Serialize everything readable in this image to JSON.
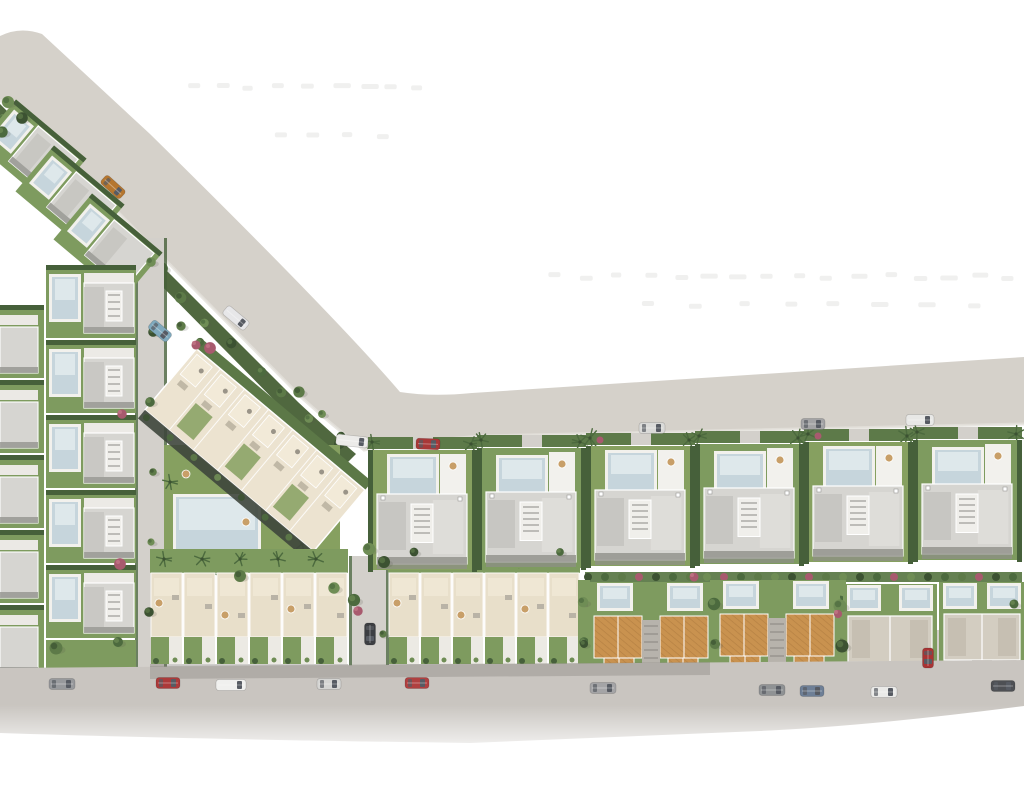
{
  "canvas": {
    "w": 1024,
    "h": 787
  },
  "palette": {
    "bg": "#ffffff",
    "road": "#d5d1ca",
    "road_edge": "#e4e1db",
    "road_bottom": "#c9c5c0",
    "road_shade": "#77736c",
    "street": "#d3d0cb",
    "lawn": "#7e9b5f",
    "lawn_alt": "#86a060",
    "hedge": "#46603a",
    "hedge_mid": "#5d7a49",
    "roof": "#d6d5d1",
    "roof_dark": "#c5c4c0",
    "roof_light": "#deddd9",
    "roof_shadow": "#94948e",
    "deck": "#f2f1ed",
    "white": "#fbfaf7",
    "pool": "#c6d5dc",
    "pool_light": "#e6edf0",
    "terrace": "#e8dfca",
    "terrace_inner": "#efe7d4",
    "apartment": "#ece3d0",
    "dark_band": "#3e463c",
    "orange": "#c9924f",
    "orange_dark": "#a5733a",
    "court": "#b7b3ac",
    "duplex_roof": "#d3cdc1",
    "pink": "#a85a6e",
    "shadow_dash": "#8d8880",
    "glass": "#575b63",
    "parasol": "#c89f68",
    "furniture": "#b9b3a6",
    "trees": [
      "#3c5232",
      "#4c6a3e",
      "#5d7a48",
      "#6f8d55"
    ]
  },
  "roads": {
    "top_road_path": "M 0,36 Q 20,26 42,34 L 150,134 Q 335,316 400,392 Q 432,397 472,393 L 1024,357 L 1024,424 L 482,436 Q 406,442 364,450 Q 332,425 302,398 L 96,190 Q 56,150 0,100 Z",
    "bottom_road_path": "M 0,668 L 1024,660 L 1024,706 Q 870,726 760,731 L 470,743 Q 180,739 0,733 Z",
    "bottom_shade_path": "M 150,666 L 710,662 L 710,675 L 150,679 Z",
    "diag_green_path": "M 0,104 L 298,402 Q 330,432 356,454 L 344,466 Q 315,442 288,414 L 0,122 Z"
  },
  "streets": [
    {
      "x": 138,
      "y": 238,
      "w": 26,
      "h": 430
    },
    {
      "x": 352,
      "y": 556,
      "w": 34,
      "h": 112
    },
    {
      "x": 918,
      "y": 630,
      "w": 24,
      "h": 38
    }
  ],
  "shadow_rows": [
    {
      "y": 82,
      "x1": 186,
      "x2": 418,
      "step": 28
    },
    {
      "y": 131,
      "x1": 272,
      "x2": 402,
      "step": 34
    },
    {
      "y": 272,
      "x1": 548,
      "x2": 1020,
      "step": 30
    },
    {
      "y": 300,
      "x1": 640,
      "x2": 980,
      "step": 46
    }
  ],
  "left_diagonal_lots": [
    {
      "cx": 32,
      "cy": 152
    },
    {
      "cx": 70,
      "cy": 198
    },
    {
      "cx": 108,
      "cy": 246
    }
  ],
  "left_columns": {
    "colA": {
      "x": 0,
      "w": 44,
      "ys": [
        305,
        380,
        455,
        530,
        605
      ]
    },
    "colB": {
      "x": 46,
      "w": 90,
      "ys": [
        265,
        340,
        415,
        490,
        565
      ]
    }
  },
  "apartment": {
    "cx": 255,
    "cy": 450,
    "w": 220,
    "h": 80,
    "rot": 40,
    "units": 7,
    "lawn": {
      "x": 164,
      "y": 445,
      "w": 176,
      "h": 128
    },
    "pool": {
      "x": 176,
      "y": 497,
      "w": 82,
      "h": 62
    },
    "palms": [
      [
        170,
        482
      ],
      [
        266,
        484
      ],
      [
        302,
        544
      ],
      [
        318,
        566
      ],
      [
        210,
        572
      ],
      [
        168,
        560
      ]
    ],
    "parasols": [
      [
        186,
        474
      ],
      [
        246,
        522
      ],
      [
        288,
        500
      ]
    ]
  },
  "townhouses": {
    "band_y": 549,
    "y": 573,
    "unit_h": 64,
    "garden_h": 27,
    "blocks": [
      {
        "x": 150,
        "n": 6,
        "uw": 33
      },
      {
        "x": 388,
        "n": 6,
        "uw": 32
      }
    ]
  },
  "upper_villas": {
    "x0": 368,
    "n": 6,
    "w": 109,
    "top0": 450,
    "slope": 2
  },
  "lower_right": {
    "hedgerow": {
      "x": 585,
      "y": 572,
      "w": 437,
      "h": 10
    },
    "orange": [
      {
        "x": 592,
        "y": 586
      },
      {
        "x": 718,
        "y": 584
      }
    ],
    "duplex": [
      {
        "x": 846,
        "w": 88,
        "y": 582
      },
      {
        "x": 942,
        "w": 80,
        "y": 580
      }
    ],
    "gap_greens": [
      578,
      710,
      834
    ]
  },
  "trees": [
    [
      151,
      262
    ],
    [
      153,
      332
    ],
    [
      150,
      402
    ],
    [
      153,
      472
    ],
    [
      151,
      542
    ],
    [
      149,
      612
    ],
    [
      118,
      642
    ],
    [
      56,
      648
    ],
    [
      369,
      549
    ],
    [
      384,
      562
    ],
    [
      354,
      600
    ],
    [
      383,
      634
    ],
    [
      583,
      602
    ],
    [
      584,
      644
    ],
    [
      714,
      604
    ],
    [
      715,
      644
    ],
    [
      840,
      606
    ],
    [
      842,
      646
    ],
    [
      1014,
      604
    ],
    [
      299,
      392
    ],
    [
      322,
      414
    ],
    [
      341,
      436
    ],
    [
      200,
      342
    ],
    [
      181,
      326
    ],
    [
      8,
      102
    ],
    [
      22,
      118
    ],
    [
      2,
      132
    ],
    [
      240,
      576
    ],
    [
      334,
      588
    ],
    [
      414,
      552
    ],
    [
      560,
      552
    ]
  ],
  "pink_bushes": [
    [
      196,
      345
    ],
    [
      358,
      611
    ],
    [
      838,
      614
    ],
    [
      694,
      577
    ],
    [
      122,
      414
    ],
    [
      120,
      564
    ],
    [
      210,
      348
    ]
  ],
  "cars": [
    {
      "x": 113,
      "y": 187,
      "r": 42,
      "c": "#b5762f",
      "l": 26
    },
    {
      "x": 236,
      "y": 318,
      "r": 40,
      "c": "#e7e7e9",
      "l": 28,
      "van": true
    },
    {
      "x": 160,
      "y": 331,
      "r": 40,
      "c": "#7fa9bd",
      "l": 24
    },
    {
      "x": 352,
      "y": 441,
      "r": 6,
      "c": "#ecebe9",
      "l": 32,
      "van": true
    },
    {
      "x": 428,
      "y": 444,
      "r": 2,
      "c": "#a83838",
      "l": 24
    },
    {
      "x": 652,
      "y": 428,
      "r": 0,
      "c": "#dadad8",
      "l": 26
    },
    {
      "x": 813,
      "y": 424,
      "r": 0,
      "c": "#a3a3a5",
      "l": 24
    },
    {
      "x": 920,
      "y": 420,
      "r": 0,
      "c": "#e8e8e6",
      "l": 28,
      "van": true
    },
    {
      "x": 62,
      "y": 684,
      "r": 0,
      "c": "#97999c",
      "l": 26
    },
    {
      "x": 168,
      "y": 683,
      "r": 0,
      "c": "#ac3a3a",
      "l": 24
    },
    {
      "x": 231,
      "y": 685,
      "r": 0,
      "c": "#f0f0ee",
      "l": 30,
      "van": true
    },
    {
      "x": 329,
      "y": 684,
      "r": 0,
      "c": "#d5d5d3",
      "l": 24
    },
    {
      "x": 417,
      "y": 683,
      "r": 0,
      "c": "#b04040",
      "l": 24
    },
    {
      "x": 603,
      "y": 688,
      "r": 0,
      "c": "#a4a4a6",
      "l": 26
    },
    {
      "x": 772,
      "y": 690,
      "r": 0,
      "c": "#8f9294",
      "l": 26
    },
    {
      "x": 812,
      "y": 691,
      "r": 0,
      "c": "#6e7f96",
      "l": 24
    },
    {
      "x": 884,
      "y": 692,
      "r": 0,
      "c": "#eaeae8",
      "l": 26
    },
    {
      "x": 1003,
      "y": 686,
      "r": 0,
      "c": "#4e5054",
      "l": 24
    },
    {
      "x": 370,
      "y": 634,
      "r": 90,
      "c": "#3c3e42",
      "l": 22
    },
    {
      "x": 928,
      "y": 658,
      "r": 90,
      "c": "#a83434",
      "l": 20
    }
  ]
}
